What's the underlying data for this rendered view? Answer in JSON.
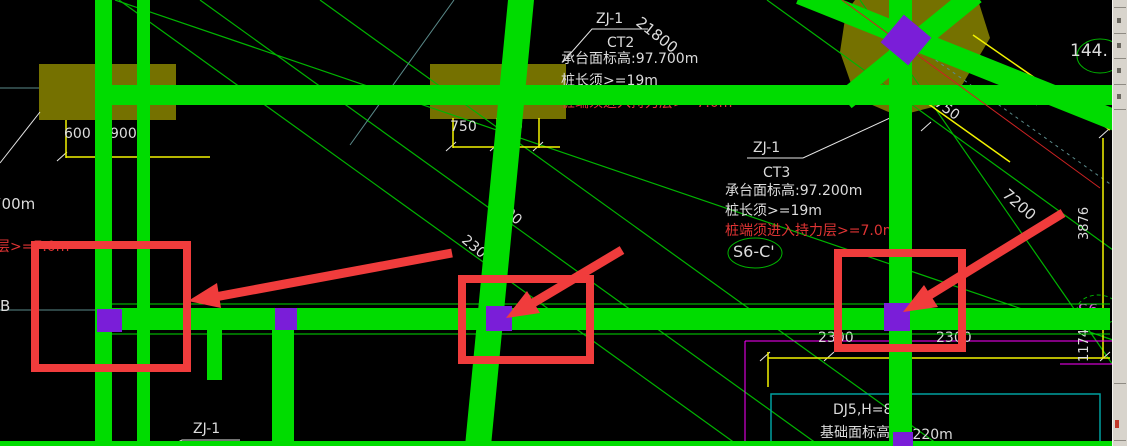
{
  "drawing": {
    "callout_ct2": {
      "ref": "ZJ-1",
      "code": "CT2",
      "elevation": "承台面标高:97.700m",
      "pile_length": "桩长须>=19m",
      "pile_warning": "桩端须进入持力层>=7.0m"
    },
    "callout_ct3": {
      "ref": "ZJ-1",
      "code": "CT3",
      "elevation": "承台面标高:97.200m",
      "pile_length": "桩长须>=19m",
      "pile_warning": "桩端须进入持力层>=7.0m"
    },
    "grid_label_s6c": "S6-C'",
    "grid_label_s6_right": "S6-",
    "grid_label_b": "B",
    "callout_zj1_bottom": "ZJ-1",
    "circle_value": "144.",
    "partial_elevation": "700m",
    "partial_warning": "层>=7.0m",
    "footing": {
      "label": "DJ5,H=8",
      "elevation_prefix": "基础面标高",
      "elevation_suffix": ".220m"
    },
    "dims": {
      "d21800": "21800",
      "d600": "600",
      "d900": "900",
      "d750a": "750",
      "d750b": "750",
      "d750diag": "750",
      "d7200": "7200",
      "d3876": "3876",
      "d1174": "1174",
      "d2300a": "2300",
      "d2300b": "2300",
      "d2300c": "2300",
      "d2300d": "2300"
    },
    "colors": {
      "beam_green": "#00dc00",
      "thin_green": "#00b400",
      "dim_yellow": "#f2f200",
      "warning_red": "#e03434",
      "highlight_red": "#f03c3c",
      "pile_purple": "#7a1ed8",
      "cap_olive": "#757100",
      "axis_teal": "#5a8a8a",
      "magenta": "#ff00ff"
    }
  }
}
